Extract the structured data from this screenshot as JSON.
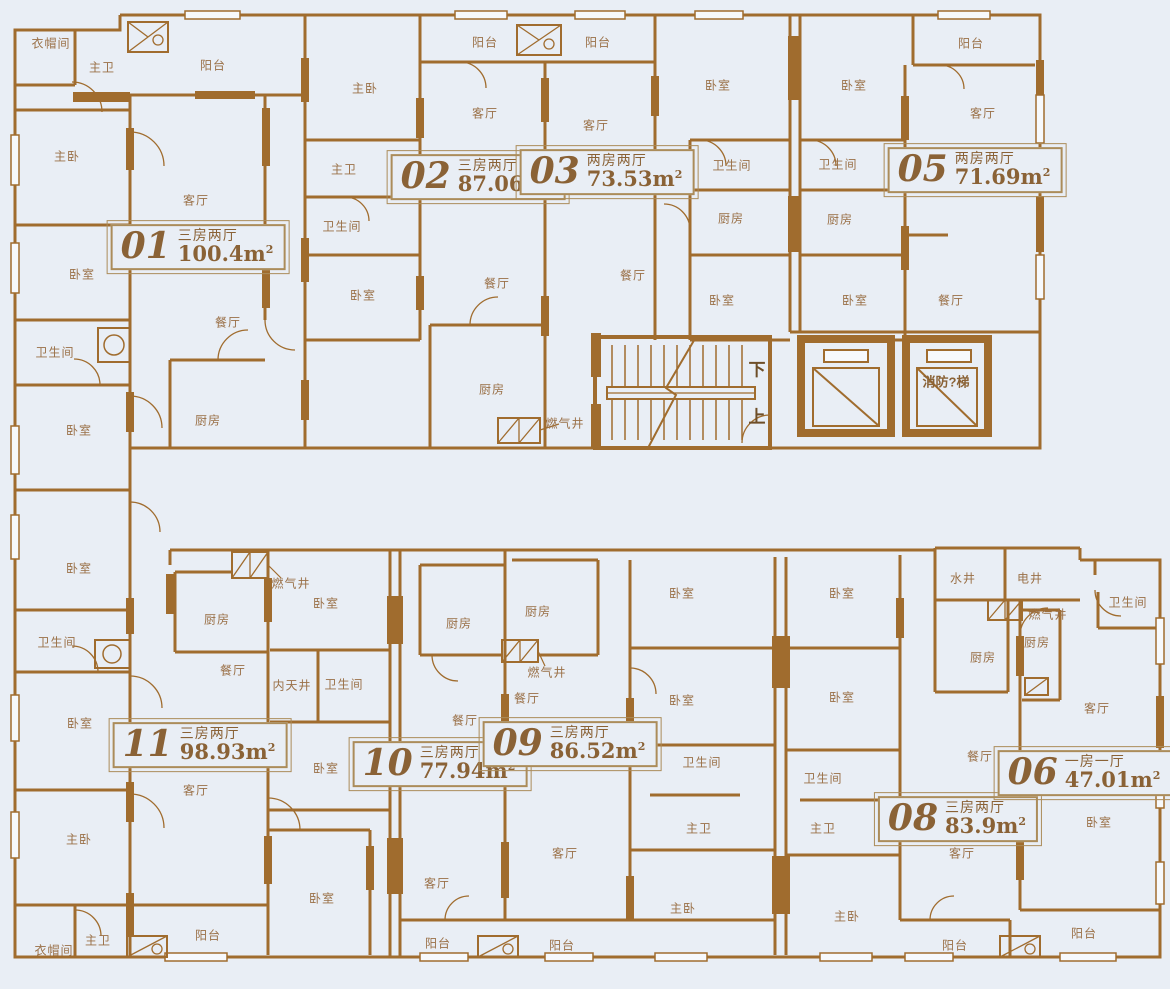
{
  "meta": {
    "background": "#e9eef5",
    "wall_color": "#a06c2e",
    "label_color": "#9a7047",
    "badge_color": "#8a6236",
    "sqm_sup": "2"
  },
  "legend": {
    "stairs_down": "下",
    "stairs_up": "上",
    "fire_elevator": "消防?梯"
  },
  "units": [
    {
      "id": "01",
      "layout": "三房两厅",
      "area": "100.4m",
      "x": 198,
      "y": 247
    },
    {
      "id": "02",
      "layout": "三房两厅",
      "area": "87.06m",
      "x": 478,
      "y": 177
    },
    {
      "id": "03",
      "layout": "两房两厅",
      "area": "73.53m",
      "x": 607,
      "y": 172
    },
    {
      "id": "05",
      "layout": "两房两厅",
      "area": "71.69m",
      "x": 975,
      "y": 170
    },
    {
      "id": "11",
      "layout": "三房两厅",
      "area": "98.93m",
      "x": 200,
      "y": 745
    },
    {
      "id": "10",
      "layout": "三房两厅",
      "area": "77.94m",
      "x": 440,
      "y": 764
    },
    {
      "id": "09",
      "layout": "三房两厅",
      "area": "86.52m",
      "x": 570,
      "y": 744
    },
    {
      "id": "08",
      "layout": "三房两厅",
      "area": "83.9m",
      "x": 958,
      "y": 819
    },
    {
      "id": "06",
      "layout": "一房一厅",
      "area": "47.01m",
      "x": 1085,
      "y": 773
    }
  ],
  "rooms": [
    {
      "t": "衣帽间",
      "x": 51,
      "y": 43
    },
    {
      "t": "主卫",
      "x": 102,
      "y": 67
    },
    {
      "t": "阳台",
      "x": 213,
      "y": 65
    },
    {
      "t": "主卧",
      "x": 67,
      "y": 156
    },
    {
      "t": "客厅",
      "x": 196,
      "y": 200
    },
    {
      "t": "卧室",
      "x": 82,
      "y": 274
    },
    {
      "t": "餐厅",
      "x": 228,
      "y": 322
    },
    {
      "t": "卫生间",
      "x": 55,
      "y": 352
    },
    {
      "t": "卧室",
      "x": 79,
      "y": 430
    },
    {
      "t": "厨房",
      "x": 208,
      "y": 420
    },
    {
      "t": "主卧",
      "x": 365,
      "y": 88
    },
    {
      "t": "阳台",
      "x": 485,
      "y": 42
    },
    {
      "t": "阳台",
      "x": 598,
      "y": 42
    },
    {
      "t": "客厅",
      "x": 485,
      "y": 113
    },
    {
      "t": "主卫",
      "x": 344,
      "y": 169
    },
    {
      "t": "卫生间",
      "x": 342,
      "y": 226
    },
    {
      "t": "卧室",
      "x": 363,
      "y": 295
    },
    {
      "t": "餐厅",
      "x": 497,
      "y": 283
    },
    {
      "t": "厨房",
      "x": 492,
      "y": 389
    },
    {
      "t": "燃气井",
      "x": 565,
      "y": 423
    },
    {
      "t": "客厅",
      "x": 596,
      "y": 125
    },
    {
      "t": "餐厅",
      "x": 633,
      "y": 275
    },
    {
      "t": "卧室",
      "x": 718,
      "y": 85
    },
    {
      "t": "卫生间",
      "x": 732,
      "y": 165
    },
    {
      "t": "厨房",
      "x": 731,
      "y": 218
    },
    {
      "t": "卧室",
      "x": 722,
      "y": 300
    },
    {
      "t": "卧室",
      "x": 854,
      "y": 85
    },
    {
      "t": "卫生间",
      "x": 838,
      "y": 164
    },
    {
      "t": "厨房",
      "x": 840,
      "y": 219
    },
    {
      "t": "卧室",
      "x": 855,
      "y": 300
    },
    {
      "t": "阳台",
      "x": 971,
      "y": 43
    },
    {
      "t": "客厅",
      "x": 983,
      "y": 113
    },
    {
      "t": "餐厅",
      "x": 951,
      "y": 300
    },
    {
      "t": "下",
      "x": 757,
      "y": 368,
      "c": "big"
    },
    {
      "t": "上",
      "x": 757,
      "y": 415,
      "c": "big"
    },
    {
      "t": "消防?梯",
      "x": 946,
      "y": 381,
      "c": "elev"
    },
    {
      "t": "卧室",
      "x": 79,
      "y": 568
    },
    {
      "t": "卫生间",
      "x": 57,
      "y": 642
    },
    {
      "t": "卧室",
      "x": 80,
      "y": 723
    },
    {
      "t": "主卧",
      "x": 79,
      "y": 839
    },
    {
      "t": "衣帽间",
      "x": 54,
      "y": 950
    },
    {
      "t": "主卫",
      "x": 98,
      "y": 940
    },
    {
      "t": "阳台",
      "x": 208,
      "y": 935
    },
    {
      "t": "燃气井",
      "x": 291,
      "y": 583
    },
    {
      "t": "厨房",
      "x": 217,
      "y": 619
    },
    {
      "t": "卧室",
      "x": 326,
      "y": 603
    },
    {
      "t": "餐厅",
      "x": 233,
      "y": 670
    },
    {
      "t": "内天井",
      "x": 292,
      "y": 685
    },
    {
      "t": "卫生间",
      "x": 344,
      "y": 684
    },
    {
      "t": "卧室",
      "x": 326,
      "y": 768
    },
    {
      "t": "客厅",
      "x": 196,
      "y": 790
    },
    {
      "t": "卧室",
      "x": 322,
      "y": 898
    },
    {
      "t": "厨房",
      "x": 459,
      "y": 623
    },
    {
      "t": "厨房",
      "x": 538,
      "y": 611
    },
    {
      "t": "燃气井",
      "x": 547,
      "y": 672
    },
    {
      "t": "餐厅",
      "x": 465,
      "y": 720
    },
    {
      "t": "餐厅",
      "x": 527,
      "y": 698
    },
    {
      "t": "客厅",
      "x": 437,
      "y": 883
    },
    {
      "t": "客厅",
      "x": 565,
      "y": 853
    },
    {
      "t": "阳台",
      "x": 438,
      "y": 943
    },
    {
      "t": "阳台",
      "x": 562,
      "y": 945
    },
    {
      "t": "卧室",
      "x": 682,
      "y": 593
    },
    {
      "t": "卧室",
      "x": 682,
      "y": 700
    },
    {
      "t": "卫生间",
      "x": 702,
      "y": 762
    },
    {
      "t": "主卫",
      "x": 699,
      "y": 828
    },
    {
      "t": "主卧",
      "x": 683,
      "y": 908
    },
    {
      "t": "卧室",
      "x": 842,
      "y": 593
    },
    {
      "t": "卧室",
      "x": 842,
      "y": 697
    },
    {
      "t": "卫生间",
      "x": 823,
      "y": 778
    },
    {
      "t": "主卫",
      "x": 823,
      "y": 828
    },
    {
      "t": "主卧",
      "x": 847,
      "y": 916
    },
    {
      "t": "水井",
      "x": 963,
      "y": 578
    },
    {
      "t": "电井",
      "x": 1030,
      "y": 578
    },
    {
      "t": "燃气井",
      "x": 1048,
      "y": 614
    },
    {
      "t": "厨房",
      "x": 983,
      "y": 657
    },
    {
      "t": "厨房",
      "x": 1037,
      "y": 642
    },
    {
      "t": "卫生间",
      "x": 1128,
      "y": 602
    },
    {
      "t": "餐厅",
      "x": 980,
      "y": 756
    },
    {
      "t": "客厅",
      "x": 962,
      "y": 853
    },
    {
      "t": "客厅",
      "x": 1097,
      "y": 708
    },
    {
      "t": "卧室",
      "x": 1099,
      "y": 822
    },
    {
      "t": "阳台",
      "x": 955,
      "y": 945
    },
    {
      "t": "阳台",
      "x": 1084,
      "y": 933
    }
  ]
}
